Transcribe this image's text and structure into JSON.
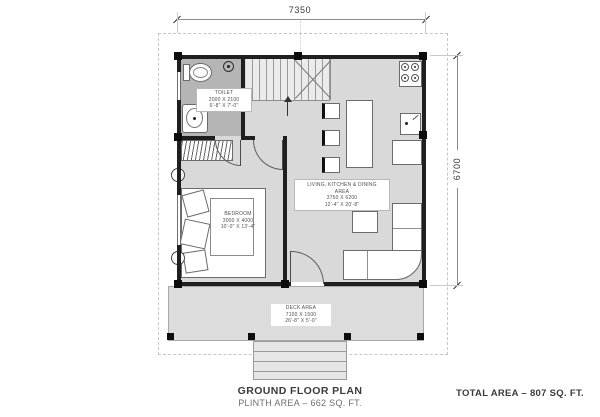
{
  "plan": {
    "title": "GROUND FLOOR PLAN",
    "subtitle": "PLINTH AREA – 662 SQ. FT.",
    "total_area": "TOTAL AREA – 807 SQ. FT.",
    "dimensions": {
      "width_mm": "7350",
      "height_mm": "6700"
    },
    "rooms": {
      "toilet": {
        "name": "TOILET",
        "size_mm": "2000 X 2100",
        "size_ft": "6'-8\" X 7'-0\""
      },
      "bedroom": {
        "name": "BEDROOM",
        "size_mm": "3000 X 4000",
        "size_ft": "10'-0\" X 13'-4\""
      },
      "living": {
        "name_line1": "LIVING, KITCHEN & DINING",
        "name_line2": "AREA",
        "size_mm": "3750 X 6200",
        "size_ft": "12'-4\" X 20'-8\""
      },
      "deck": {
        "name": "DECK AREA",
        "size_mm": "7100 X 1500",
        "size_ft": "26'-8\" X 5'-0\""
      }
    },
    "colors": {
      "wall": "#1f1f1f",
      "floor": "#d9d9d9",
      "toilet_floor": "#b5b5b5",
      "deck_floor": "#dcdcdc"
    }
  }
}
